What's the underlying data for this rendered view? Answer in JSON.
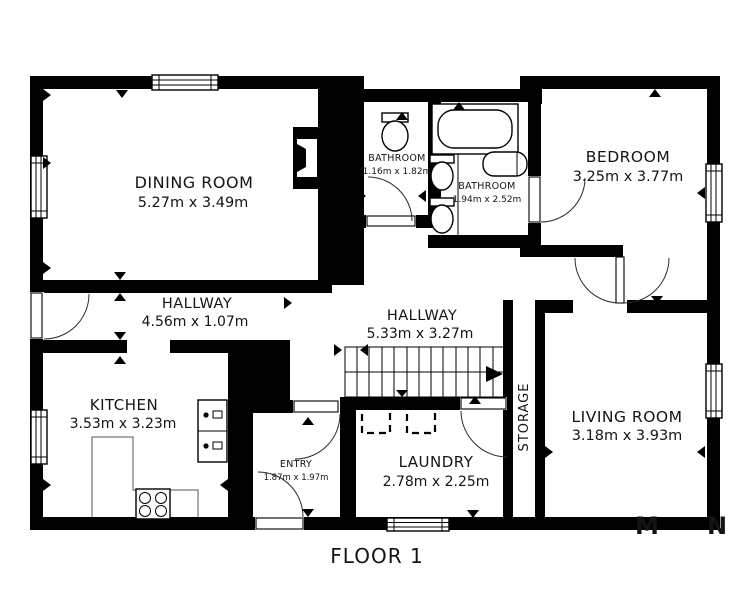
{
  "title": "FLOOR 1",
  "rooms": {
    "dining": {
      "name": "DINING ROOM",
      "dims": "5.27m x 3.49m"
    },
    "bathroom1": {
      "name": "BATHROOM",
      "dims": "1.16m x 1.82m"
    },
    "bathroom2": {
      "name": "BATHROOM",
      "dims": "1.94m x 2.52m"
    },
    "bedroom": {
      "name": "BEDROOM",
      "dims": "3.25m x 3.77m"
    },
    "hallway1": {
      "name": "HALLWAY",
      "dims": "4.56m x 1.07m"
    },
    "hallway2": {
      "name": "HALLWAY",
      "dims": "5.33m x 3.27m"
    },
    "kitchen": {
      "name": "KITCHEN",
      "dims": "3.53m x 3.23m"
    },
    "entry": {
      "name": "ENTRY",
      "dims": "1.87m x 1.97m"
    },
    "laundry": {
      "name": "LAUNDRY",
      "dims": "2.78m x 2.25m"
    },
    "storage": {
      "name": "STORAGE"
    },
    "living": {
      "name": "LIVING ROOM",
      "dims": "3.18m x 3.93m"
    }
  },
  "watermark": {
    "letter1": "M",
    "letter2": "N"
  },
  "colors": {
    "wall": "#000000",
    "floor": "#ffffff",
    "watermark": "#9b9b9b"
  }
}
